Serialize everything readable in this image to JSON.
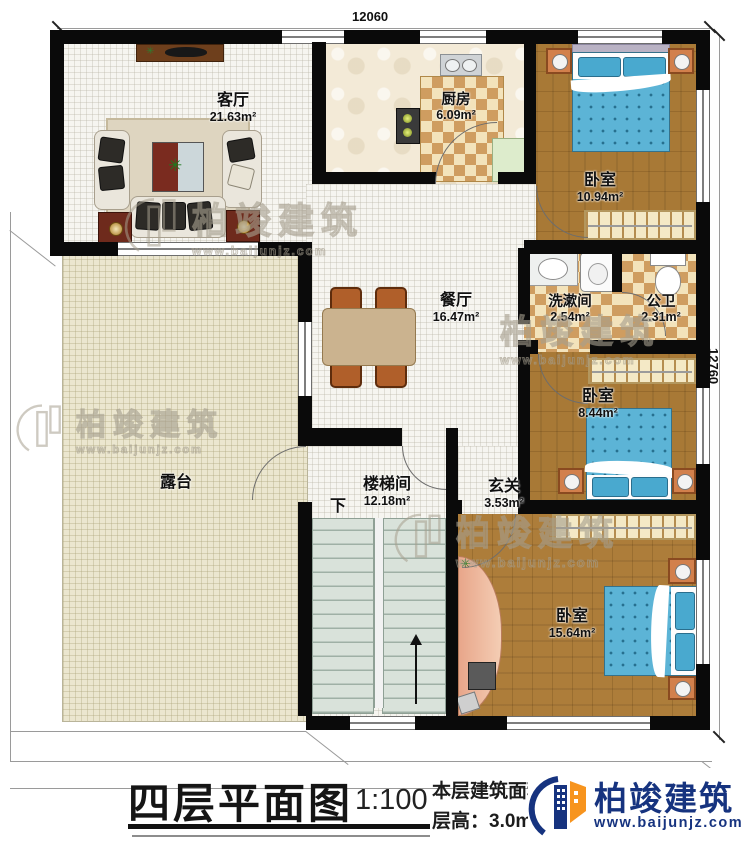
{
  "dimensions": {
    "top": "12060",
    "right": "12760"
  },
  "rooms": {
    "living": {
      "name": "客厅",
      "area": "21.63m²"
    },
    "kitchen": {
      "name": "厨房",
      "area": "6.09m²"
    },
    "bedroom_top": {
      "name": "卧室",
      "area": "10.94m²"
    },
    "dining": {
      "name": "餐厅",
      "area": "16.47m²"
    },
    "washroom": {
      "name": "洗漱间",
      "area": "2.54m²"
    },
    "toilet": {
      "name": "公卫",
      "area": "2.31m²"
    },
    "bedroom_mid": {
      "name": "卧室",
      "area": "8.44m²"
    },
    "hall": {
      "name": "玄关",
      "area": "3.53m²"
    },
    "stairwell": {
      "name": "楼梯间",
      "area": "12.18m²"
    },
    "terrace": {
      "name": "露台",
      "area": ""
    },
    "bedroom_bottom": {
      "name": "卧室",
      "area": "15.64m²"
    }
  },
  "stairs": {
    "down_label": "下"
  },
  "title_block": {
    "title": "四层平面图",
    "scale": "1:100",
    "floor_area": "本层建筑面积：122.63m²",
    "floor_height": "层高：3.0m"
  },
  "watermark": {
    "brand": "柏竣建筑",
    "url": "www.baijunjz.com"
  },
  "logo": {
    "brand": "柏竣建筑",
    "url": "www.baijunjz.com"
  },
  "icons": {
    "plant": "✳"
  }
}
